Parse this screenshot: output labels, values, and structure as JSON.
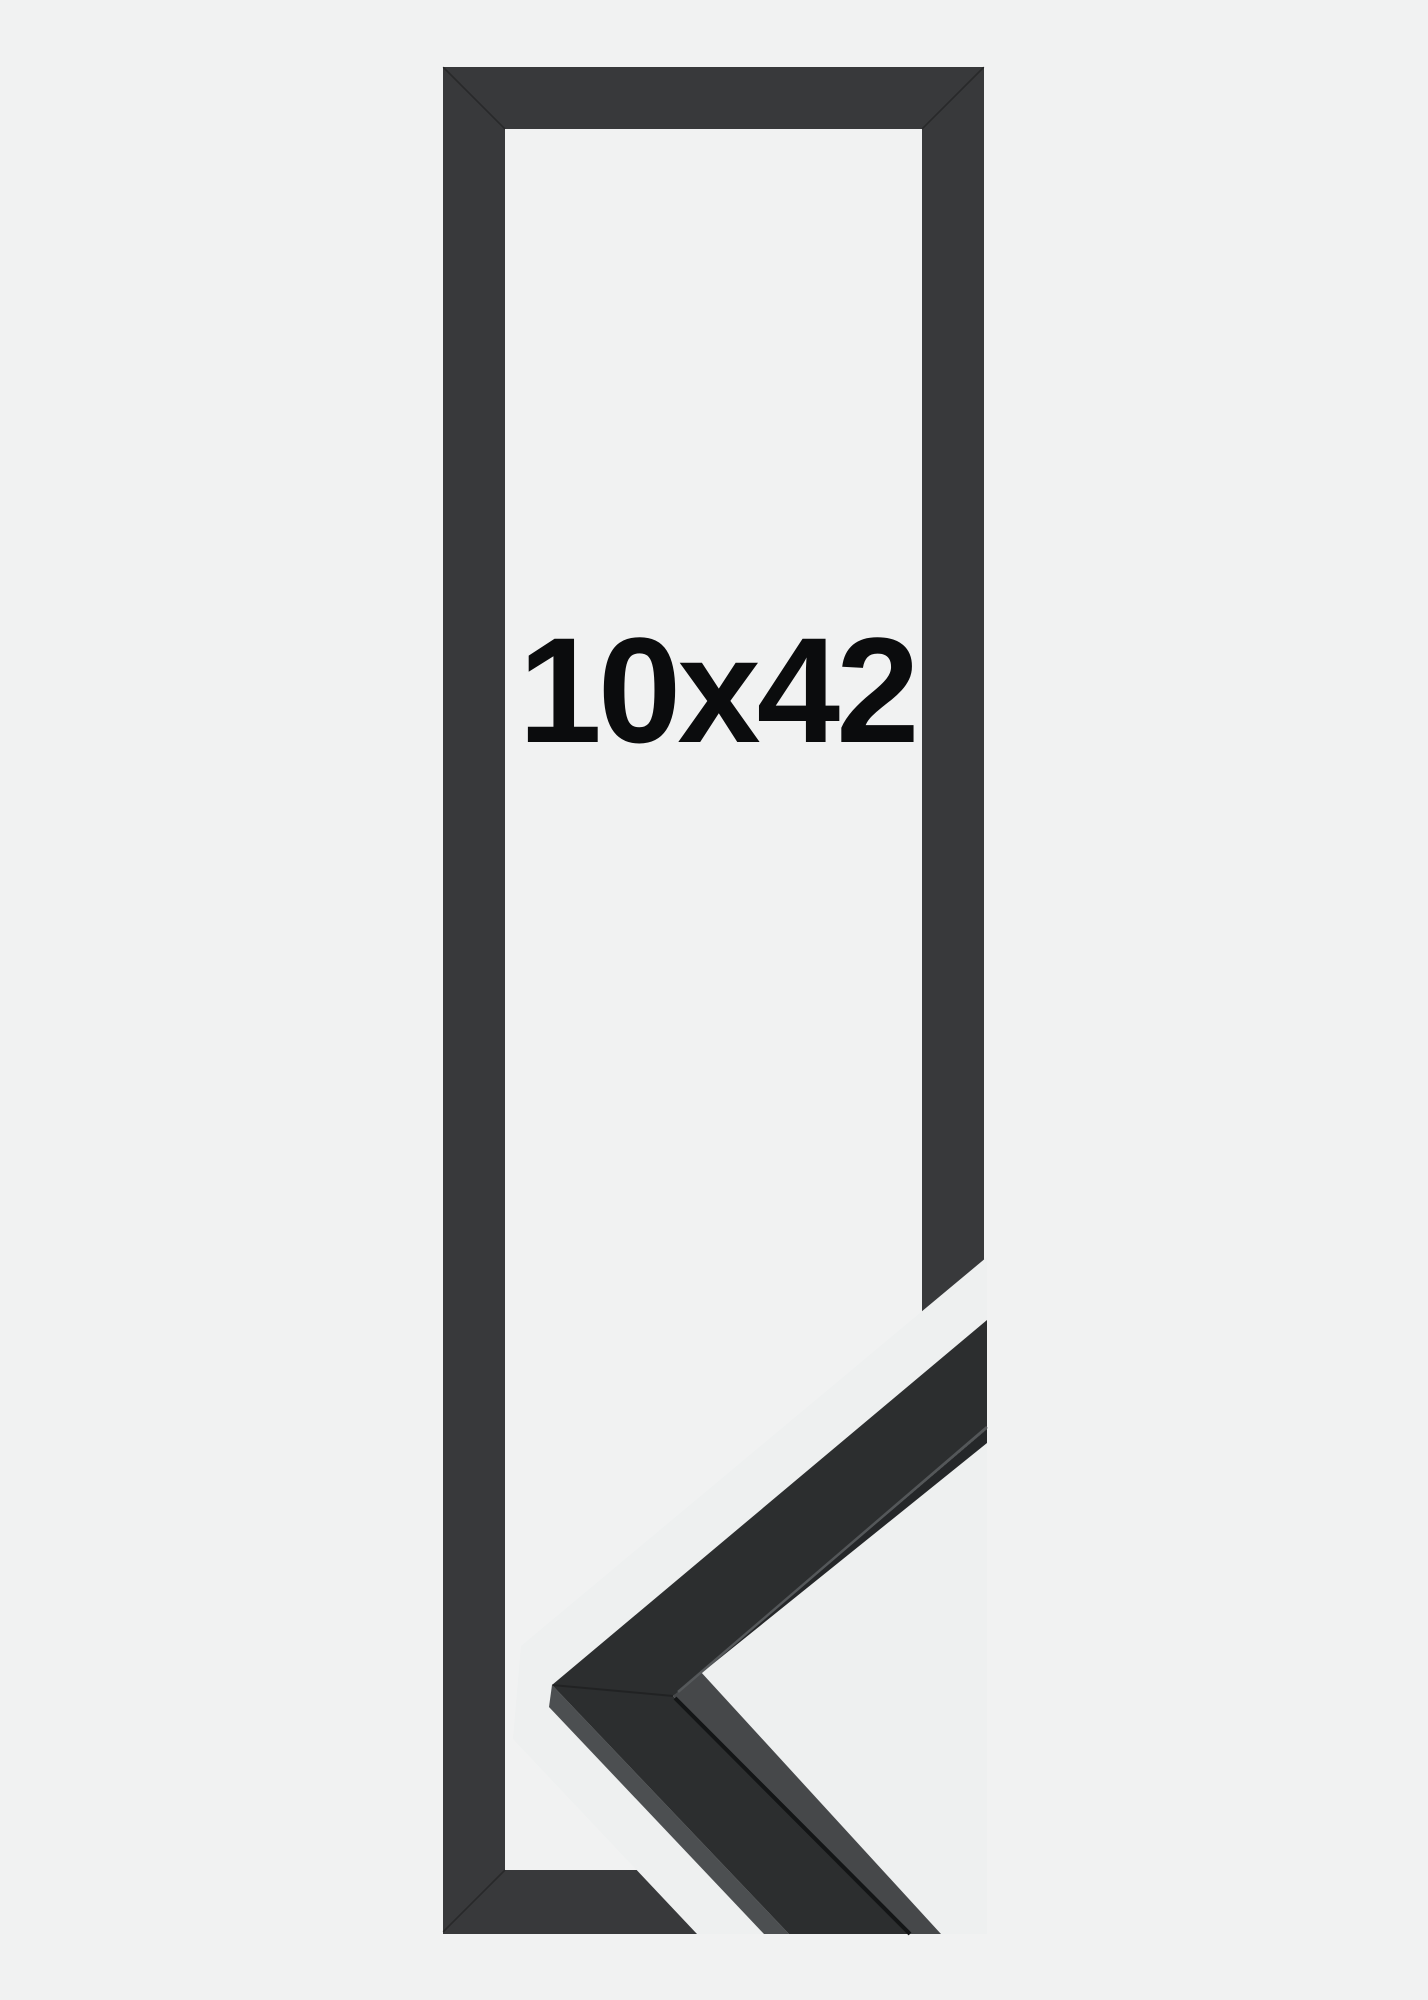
{
  "product": {
    "size_label": "10x42",
    "description": "black gallery picture frame, portrait orientation, with moulding corner profile sample"
  },
  "colors": {
    "page-bg": "#f1f2f2",
    "window-bg": "#f1f2f2",
    "sample-bg": "#eef0f0",
    "frame": "#38393b",
    "frame-seam": "#202122",
    "moulding-front": "#2c2e2f",
    "moulding-side": "#46484a",
    "moulding-outer-edge": "#4c4f51",
    "moulding-under-edge": "#252729",
    "moulding-seam": "#131516",
    "moulding-highlight": "#595c5e",
    "label-text": "#0b0c0d"
  }
}
